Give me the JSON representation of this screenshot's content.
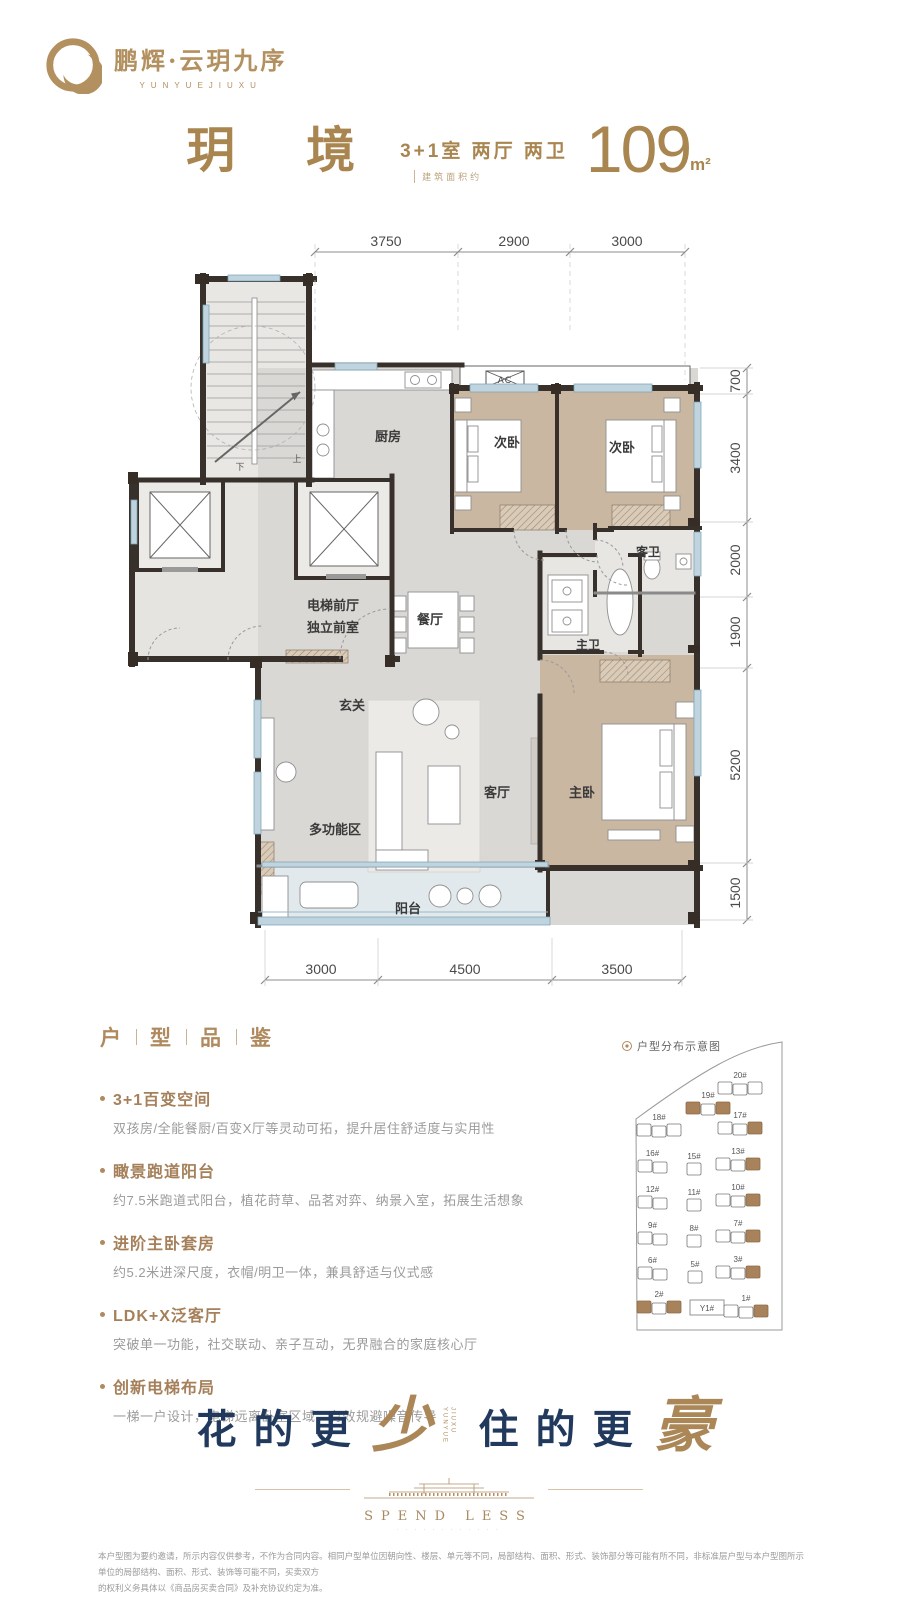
{
  "brand": {
    "name": "鹏辉·云玥九序",
    "name_en": "YUNYUEJIUXU"
  },
  "header": {
    "title": "玥 境",
    "layout": "3+1室 两厅 两卫",
    "area_prefix": "建筑面积约",
    "area_value": "109",
    "area_unit": "m²"
  },
  "floorplan": {
    "dims_top": [
      "3750",
      "2900",
      "3000"
    ],
    "dims_right": [
      "700",
      "3400",
      "2000",
      "1900",
      "5200",
      "1500"
    ],
    "dims_bottom": [
      "3000",
      "4500",
      "3500"
    ],
    "rooms": {
      "kitchen": "厨房",
      "bedroom2_left": "次卧",
      "bedroom2_right": "次卧",
      "guest_bath": "客卫",
      "master_bath": "主卫",
      "dining": "餐厅",
      "elevator_hall_line1": "电梯前厅",
      "elevator_hall_line2": "独立前室",
      "foyer": "玄关",
      "multifunction": "多功能区",
      "living": "客厅",
      "master_bedroom": "主卧",
      "balcony": "阳台",
      "ac": "AC",
      "stair_down": "下",
      "stair_up": "上"
    }
  },
  "selling_points": {
    "section_title": [
      "户",
      "型",
      "品",
      "鉴"
    ],
    "items": [
      {
        "title": "3+1百变空间",
        "desc": "双孩房/全能餐厨/百变X厅等灵动可拓，提升居住舒适度与实用性"
      },
      {
        "title": "瞰景跑道阳台",
        "desc": "约7.5米跑道式阳台，植花莳草、品茗对弈、纳景入室，拓展生活想象"
      },
      {
        "title": "进阶主卧套房",
        "desc": "约5.2米进深尺度，衣帽/明卫一体，兼具舒适与仪式感"
      },
      {
        "title": "LDK+X泛客厅",
        "desc": "突破单一功能，社交联动、亲子互动，无界融合的家庭核心厅"
      },
      {
        "title": "创新电梯布局",
        "desc": "一梯一户设计，电梯远离卧室区域，有效规避噪音传导"
      }
    ]
  },
  "siteplan": {
    "legend": "户型分布示意图",
    "buildings": [
      {
        "label": "20#",
        "x": 718,
        "y": 1082,
        "units": 3,
        "hl": []
      },
      {
        "label": "19#",
        "x": 686,
        "y": 1102,
        "units": 3,
        "hl": [
          0,
          2
        ]
      },
      {
        "label": "18#",
        "x": 637,
        "y": 1124,
        "units": 3,
        "hl": []
      },
      {
        "label": "17#",
        "x": 718,
        "y": 1122,
        "units": 3,
        "hl": [
          2
        ]
      },
      {
        "label": "16#",
        "x": 638,
        "y": 1160,
        "units": 2,
        "hl": []
      },
      {
        "label": "15#",
        "x": 687,
        "y": 1163,
        "units": 1,
        "hl": []
      },
      {
        "label": "13#",
        "x": 716,
        "y": 1158,
        "units": 3,
        "hl": [
          2
        ]
      },
      {
        "label": "12#",
        "x": 638,
        "y": 1196,
        "units": 2,
        "hl": []
      },
      {
        "label": "11#",
        "x": 687,
        "y": 1199,
        "units": 1,
        "hl": []
      },
      {
        "label": "10#",
        "x": 716,
        "y": 1194,
        "units": 3,
        "hl": [
          2
        ]
      },
      {
        "label": "9#",
        "x": 638,
        "y": 1232,
        "units": 2,
        "hl": []
      },
      {
        "label": "8#",
        "x": 687,
        "y": 1235,
        "units": 1,
        "hl": []
      },
      {
        "label": "7#",
        "x": 716,
        "y": 1230,
        "units": 3,
        "hl": [
          2
        ]
      },
      {
        "label": "6#",
        "x": 638,
        "y": 1267,
        "units": 2,
        "hl": []
      },
      {
        "label": "5#",
        "x": 688,
        "y": 1271,
        "units": 1,
        "hl": []
      },
      {
        "label": "3#",
        "x": 716,
        "y": 1266,
        "units": 3,
        "hl": [
          2
        ]
      },
      {
        "label": "2#",
        "x": 637,
        "y": 1301,
        "units": 3,
        "hl": [
          0,
          2
        ]
      },
      {
        "label": "Y1#",
        "x": 690,
        "y": 1300,
        "units": 0,
        "box": true,
        "hl": []
      },
      {
        "label": "1#",
        "x": 724,
        "y": 1305,
        "units": 3,
        "hl": [
          2
        ]
      }
    ]
  },
  "slogan": {
    "left": "花的更",
    "accent_left": "少",
    "vertical_line1": "YUNYUE",
    "vertical_line2": "JIUXU",
    "right": "住的更",
    "accent_right": "豪",
    "en": "SPEND LESS",
    "en_sub": "· · · · · · · · · · · ·"
  },
  "disclaimer": {
    "line1": "本户型图为要约邀请，所示内容仅供参考，不作为合同内容。相同户型单位因朝向性、楼层、单元等不同，局部结构、面积、形式、装饰部分等可能有所不同，非标准层户型与本户型图所示单位的局部结构、面积、形式、装饰等可能不同，买卖双方",
    "line2": "的权利义务具体以《商品房买卖合同》及补充协议约定为准。"
  },
  "colors": {
    "brand_gold": "#b08a5e",
    "navy": "#21395d",
    "wall": "#38302a",
    "wood": "#c9b7a1",
    "window_blue": "#bfd4df",
    "highlight_unit": "#a8825a"
  }
}
